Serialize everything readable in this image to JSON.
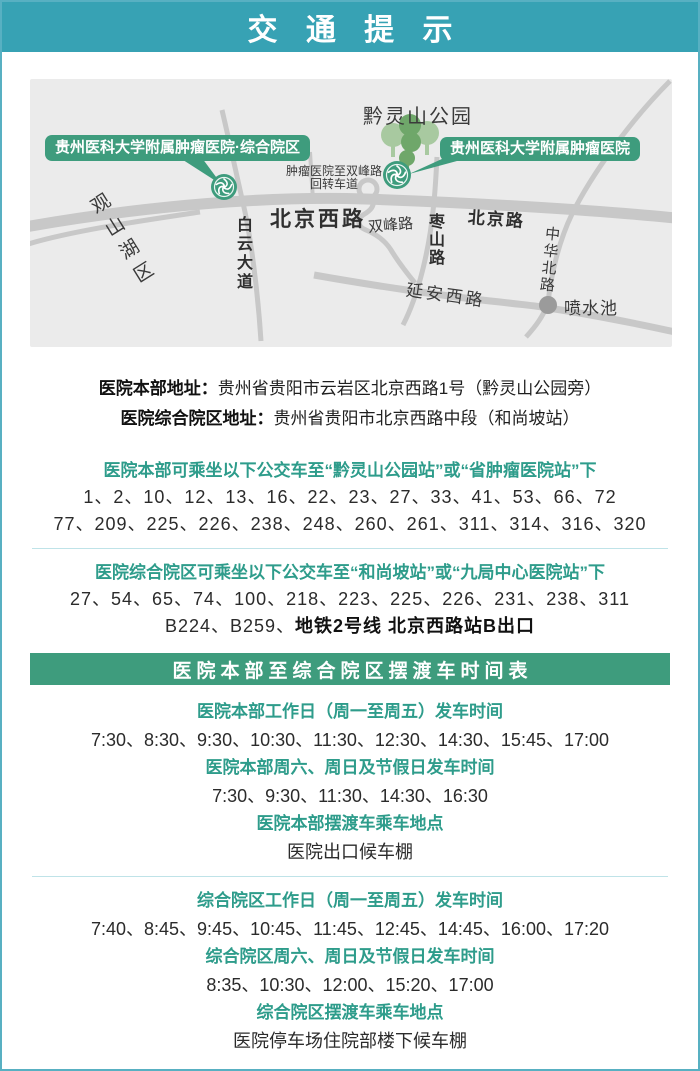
{
  "colors": {
    "header_bg": "#37a2b4",
    "page_border": "#58b0c2",
    "accent_green": "#3e9c7d",
    "teal_text": "#2e9c8b",
    "map_bg": "#ebebeb",
    "road_gray": "#c8c8c8"
  },
  "header": {
    "title": "交 通 提 示"
  },
  "map": {
    "park_label": "黔灵山公园",
    "district_label": "观山湖区",
    "campus_main_label": "贵州医科大学附属肿瘤医院",
    "campus_branch_label": "贵州医科大学附属肿瘤医院·综合院区",
    "uturn_note_line1": "肿瘤医院至双峰路",
    "uturn_note_line2": "回转车道",
    "fountain_label": "喷水池",
    "roads": {
      "beijing_west": "北京西路",
      "beijing": "北京路",
      "baiyun": "白云大道",
      "shuangfeng": "双峰路",
      "zaoshan": "枣山路",
      "zhonghua_north": "中华北路",
      "yanan_west": "延安西路"
    }
  },
  "addresses": [
    {
      "label": "医院本部地址：",
      "value": "贵州省贵阳市云岩区北京西路1号（黔灵山公园旁）"
    },
    {
      "label": "医院综合院区地址：",
      "value": "贵州省贵阳市北京西路中段（和尚坡站）"
    }
  ],
  "bus_sections": [
    {
      "heading": "医院本部可乘坐以下公交车至“黔灵山公园站”或“省肿瘤医院站”下",
      "line1": "1、2、10、12、13、16、22、23、27、33、41、53、66、72",
      "line2": "77、209、225、226、238、248、260、261、311、314、316、320"
    },
    {
      "heading": "医院综合院区可乘坐以下公交车至“和尚坡站”或“九局中心医院站”下",
      "line1": "27、54、65、74、100、218、223、225、226、231、238、311",
      "line2_prefix": "B224、B259、",
      "line2_bold": "地铁2号线 北京西路站B出口"
    }
  ],
  "shuttle": {
    "banner": "医院本部至综合院区摆渡车时间表",
    "blocks": [
      {
        "h1": "医院本部工作日（周一至周五）发车时间",
        "t1": "7:30、8:30、9:30、10:30、11:30、12:30、14:30、15:45、17:00",
        "h2": "医院本部周六、周日及节假日发车时间",
        "t2": "7:30、9:30、11:30、14:30、16:30",
        "h3": "医院本部摆渡车乘车地点",
        "t3": "医院出口候车棚"
      },
      {
        "h1": "综合院区工作日（周一至周五）发车时间",
        "t1": "7:40、8:45、9:45、10:45、11:45、12:45、14:45、16:00、17:20",
        "h2": "综合院区周六、周日及节假日发车时间",
        "t2": "8:35、10:30、12:00、15:20、17:00",
        "h3": "综合院区摆渡车乘车地点",
        "t3": "医院停车场住院部楼下候车棚"
      }
    ]
  }
}
